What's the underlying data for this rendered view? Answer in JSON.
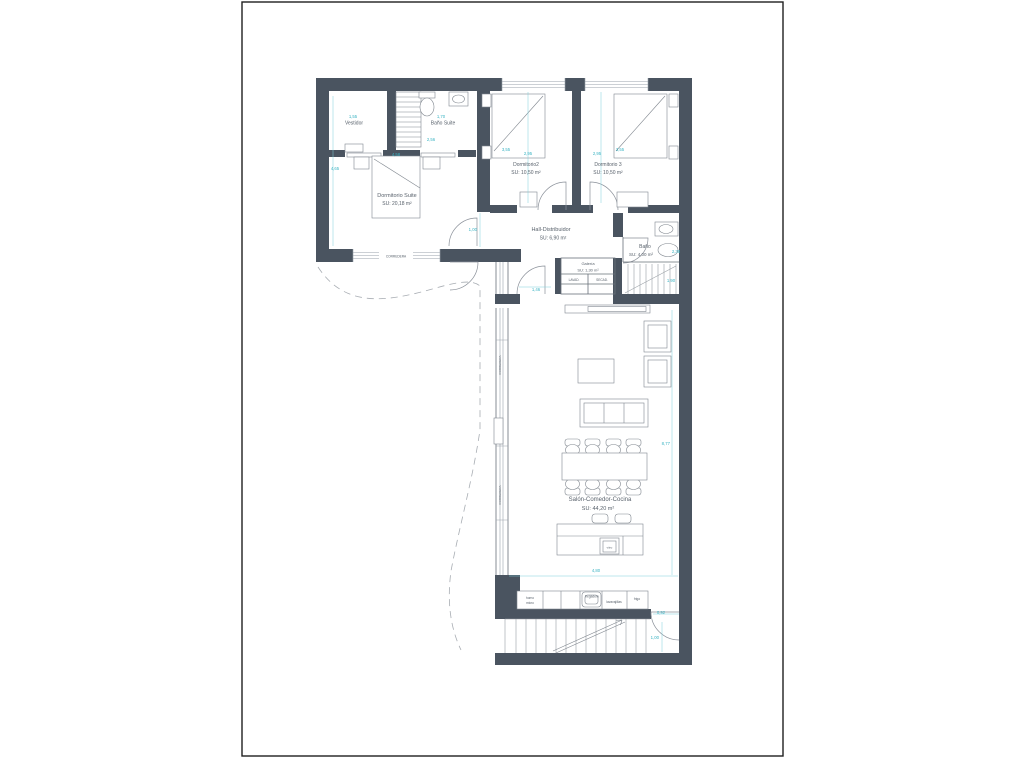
{
  "rooms": {
    "vestidor": {
      "name": "Vestidor",
      "dim_width": "1,55"
    },
    "bano_suite": {
      "name": "Baño Suite",
      "dim_width": "1,70",
      "dim_height": "2,56"
    },
    "dorm_suite": {
      "name": "Dormitorio Suite",
      "area": "SU: 20,18 m²",
      "dim_width": "4,58",
      "dim_height": "4,65",
      "window_label": "CORREDERA"
    },
    "dorm2": {
      "name": "Dormitorio2",
      "area": "SU: 10,50 m²",
      "dim_diag": "3,55",
      "dim_width": "2,95"
    },
    "dorm3": {
      "name": "Dormitorio 3",
      "area": "SU: 10,50 m²",
      "dim_width": "2,95",
      "dim_diag": "3,55"
    },
    "hall": {
      "name": "Hall-Distribuidor",
      "area": "SU: 6,90 m²",
      "dim_width": "1,00",
      "dim_pass": "1,46"
    },
    "bano": {
      "name": "Baño",
      "area": "SU: 4,00 m²",
      "dim_width": "2,38"
    },
    "galeria": {
      "name": "Galería",
      "area": "SU: 1,30 m²",
      "washer": "LAVAD.",
      "dryer": "SECAD."
    },
    "salon": {
      "name": "Salón-Comedor-Cocina",
      "area": "SU: 44,20 m²",
      "dim_height": "8,77",
      "dim_width": "4,80",
      "window_label_a": "CORREDERA",
      "window_label_b": "CORREDERA",
      "island_hob": "vitro"
    },
    "stairs_interior": {
      "dim": "1,90"
    }
  },
  "kitchen": {
    "oven_line1": "horno",
    "oven_line2": "micro",
    "sink": "fregadero",
    "dishwasher": "lavavajillas",
    "fridge": "frigo"
  },
  "entry": {
    "dim_door": "0,92",
    "dim_landing": "1,00"
  }
}
